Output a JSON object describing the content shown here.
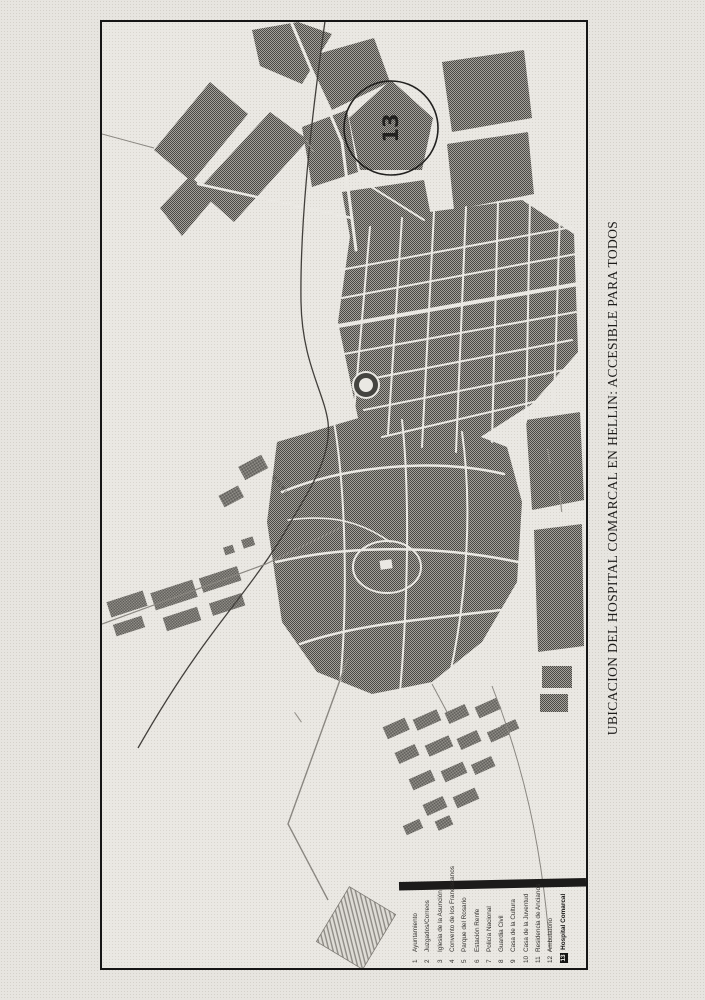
{
  "page": {
    "title": "UBICACION DEL HOSPITAL COMARCAL EN HELLIN: ACCESIBLE PARA TODOS"
  },
  "map": {
    "marker_number": "13",
    "railway_label": "MADRID",
    "colors": {
      "paper": "#e7e5e0",
      "block_gray": "#6f6d68",
      "frame_border": "#161616",
      "marker_ink": "#22211f"
    }
  },
  "legend": {
    "items": [
      {
        "number": "1",
        "label": "Ayuntamiento"
      },
      {
        "number": "2",
        "label": "Juzgados/Correos"
      },
      {
        "number": "3",
        "label": "Iglesia de la Asunción"
      },
      {
        "number": "4",
        "label": "Convento de los Franciscanos"
      },
      {
        "number": "5",
        "label": "Parque del Rosario"
      },
      {
        "number": "6",
        "label": "Estación Renfe"
      },
      {
        "number": "7",
        "label": "Policía Nacional"
      },
      {
        "number": "8",
        "label": "Guardia Civil"
      },
      {
        "number": "9",
        "label": "Casa de la Cultura"
      },
      {
        "number": "10",
        "label": "Casa de la Juventud"
      },
      {
        "number": "11",
        "label": "Residencia de Ancianos"
      },
      {
        "number": "12",
        "label": "Ambulatorio"
      },
      {
        "number": "13",
        "label": "Hospital Comarcal"
      }
    ]
  }
}
